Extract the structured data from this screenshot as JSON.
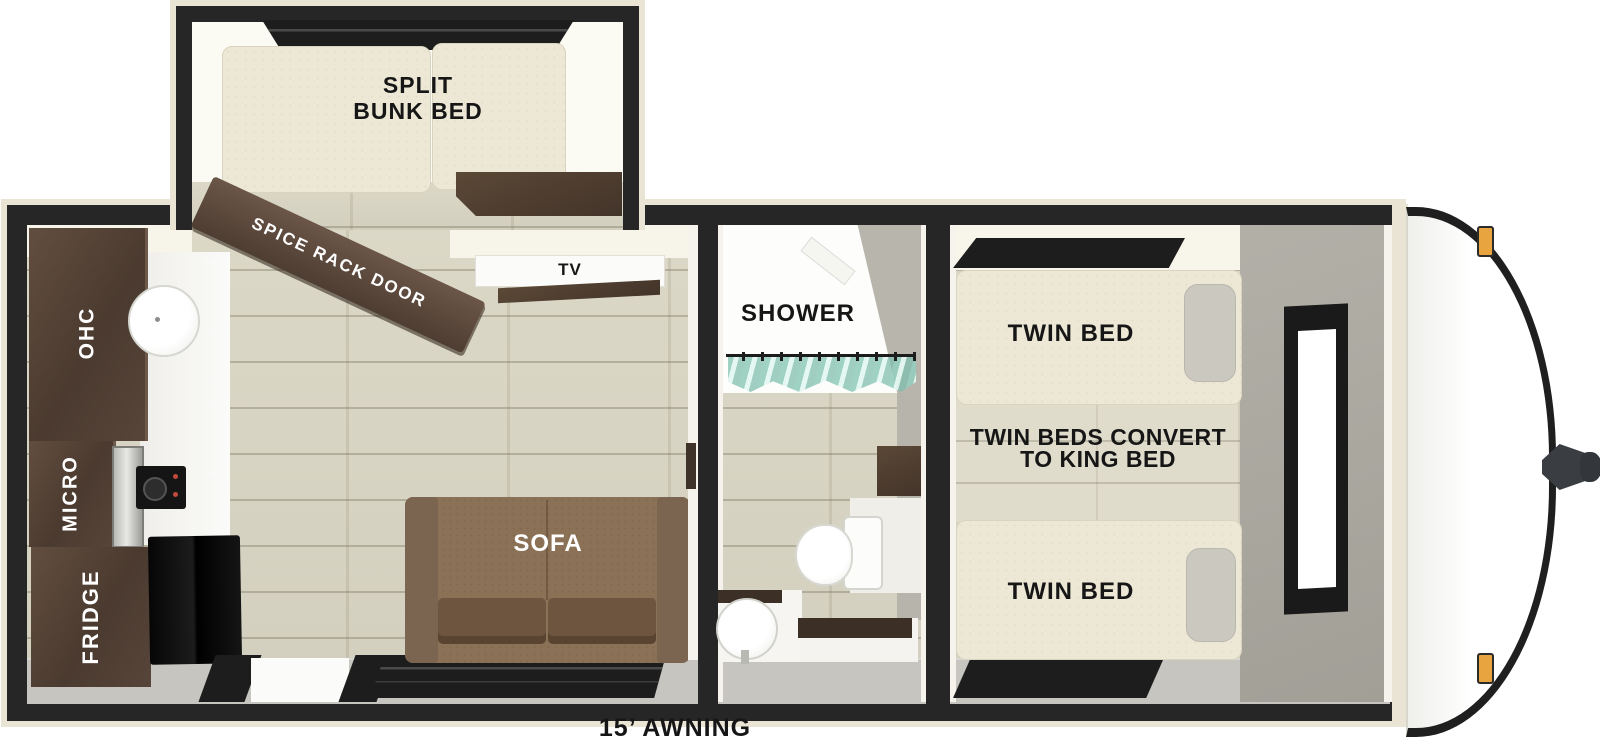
{
  "plan": {
    "awning": "15’ AWNING",
    "bunk_room": {
      "label_line1": "SPLIT",
      "label_line2": "BUNK BED",
      "spice_rack": "SPICE RACK DOOR"
    },
    "kitchen": {
      "ohc": "OHC",
      "micro": "MICRO",
      "fridge": "FRIDGE"
    },
    "living": {
      "tv": "TV",
      "sofa": "SOFA"
    },
    "bathroom": {
      "shower": "SHOWER"
    },
    "bedroom": {
      "bed_front": "TWIN BED",
      "bed_rear": "TWIN BED",
      "note_line1": "TWIN BEDS CONVERT",
      "note_line2": "TO KING BED"
    },
    "colors": {
      "wall": "#262626",
      "exterior_trim": "#e9e4d3",
      "floor_wood": "#d6d2c0",
      "cabinet_brown": "#554336",
      "sofa_brown": "#8b7156",
      "mattress_cream": "#ece8d5",
      "marker_light_amber": "#e8a43e",
      "shower_curtain_teal": "#9ecdbd"
    }
  }
}
